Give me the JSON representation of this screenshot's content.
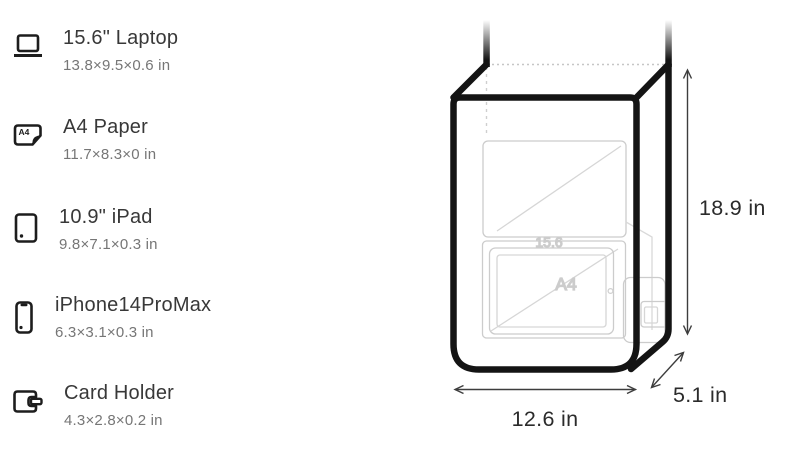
{
  "sidebar": {
    "items": [
      {
        "label": "15.6\" Laptop",
        "dims": "13.8×9.5×0.6 in"
      },
      {
        "label": "A4 Paper",
        "dims": "11.7×8.3×0 in"
      },
      {
        "label": "10.9\" iPad",
        "dims": "9.8×7.1×0.3 in"
      },
      {
        "label": "iPhone14ProMax",
        "dims": "6.3×3.1×0.3 in"
      },
      {
        "label": "Card Holder",
        "dims": "4.3×2.8×0.2 in"
      }
    ]
  },
  "diagram": {
    "height_label": "18.9 in",
    "width_label": "12.6 in",
    "depth_label": "5.1 in",
    "laptop_tag": "15.6",
    "a4_tag": "A4",
    "icon_names": [
      "laptop-icon",
      "a4-paper-icon",
      "ipad-icon",
      "iphone-icon",
      "card-holder-icon"
    ],
    "colors": {
      "bag_outline": "#141414",
      "faint_outline": "#cccccc",
      "dimension_line": "#3d3d3d",
      "dimension_text": "#2b2b2b"
    }
  }
}
